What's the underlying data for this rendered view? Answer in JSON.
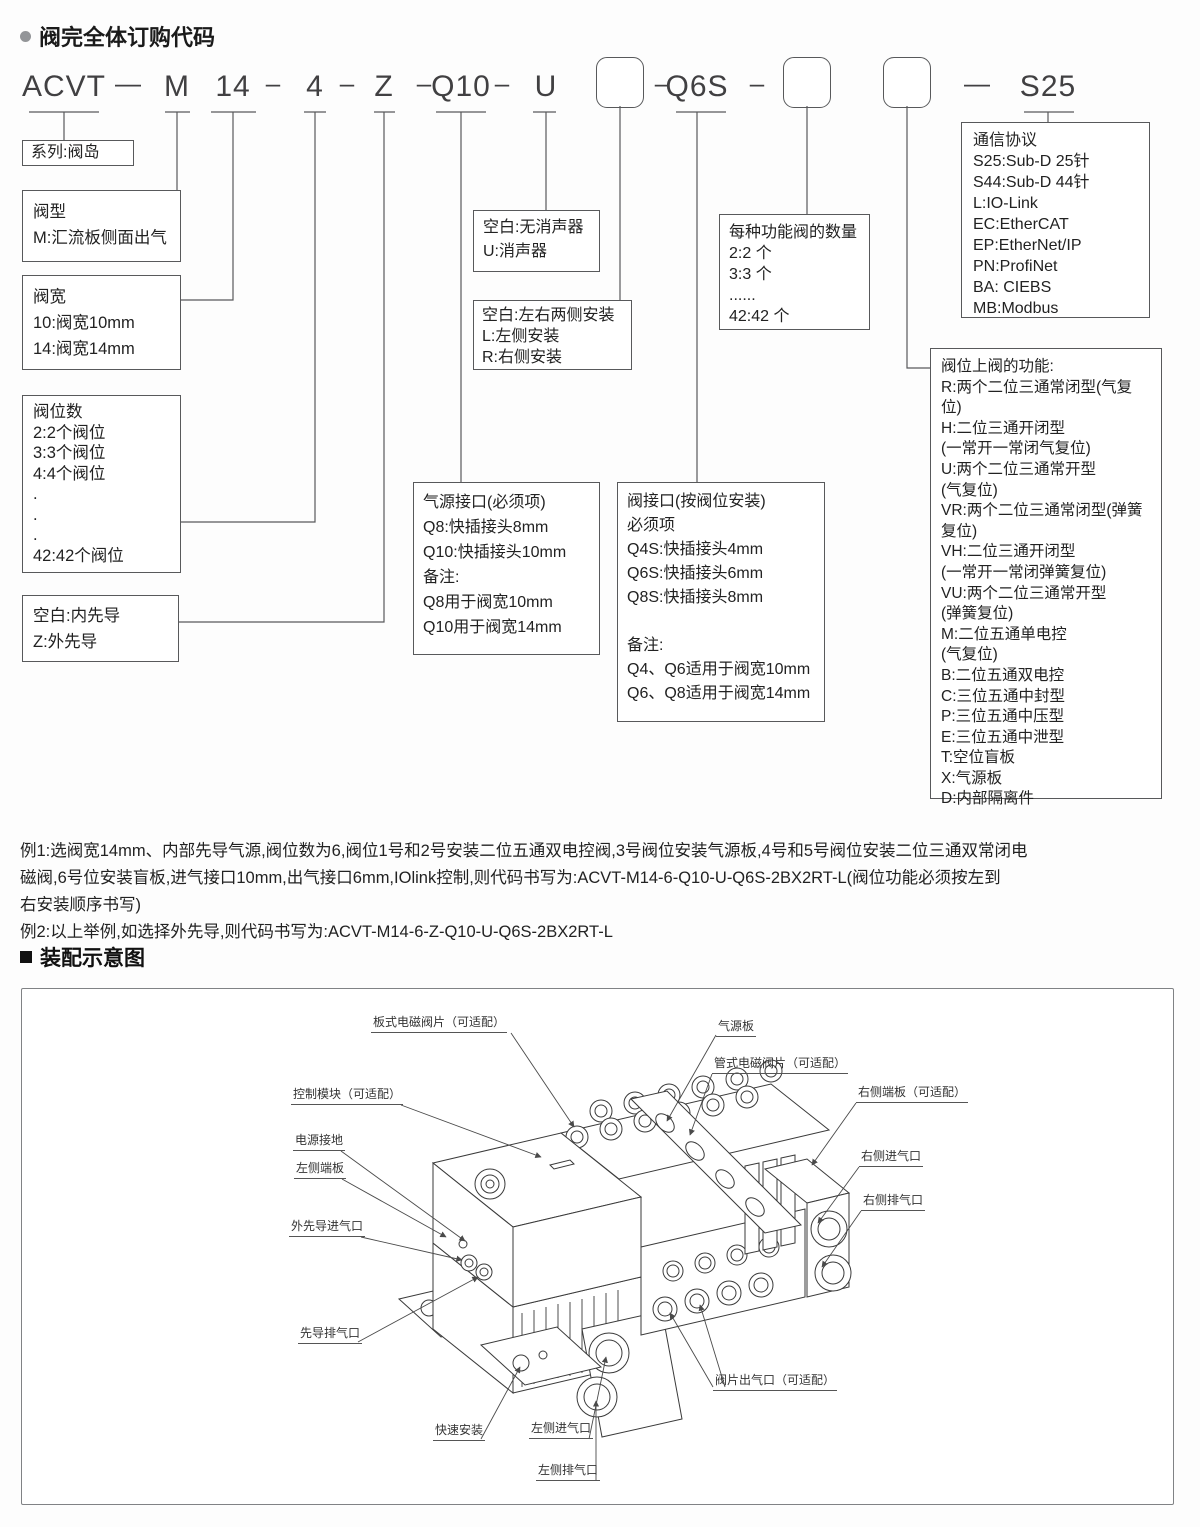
{
  "header": {
    "title": "阀完全体订购代码"
  },
  "code": {
    "segments": [
      "ACVT",
      "M",
      "14",
      "4",
      "Z",
      "Q10",
      "U",
      "Q6S",
      "S25"
    ],
    "dash_long": "—",
    "dash_short": "–"
  },
  "spec_boxes": {
    "series": "系列:阀岛",
    "valve_type": "阀型\nM:汇流板侧面出气",
    "valve_width": "阀宽\n10:阀宽10mm\n14:阀宽14mm",
    "positions": "阀位数\n2:2个阀位\n3:3个阀位\n4:4个阀位\n.\n.\n.\n42:42个阀位",
    "pilot": "空白:内先导\nZ:外先导",
    "muffler": "空白:无消声器\nU:消声器",
    "mounting": "空白:左右两侧安装\nL:左侧安装\nR:右侧安装",
    "air_port": "气源接口(必须项)\nQ8:快插接头8mm\nQ10:快插接头10mm\n备注:\nQ8用于阀宽10mm\nQ10用于阀宽14mm",
    "valve_port": "阀接口(按阀位安装)\n必须项\nQ4S:快插接头4mm\nQ6S:快插接头6mm\nQ8S:快插接头8mm\n\n备注:\nQ4、Q6适用于阀宽10mm\nQ6、Q8适用于阀宽14mm",
    "quantity": "每种功能阀的数量\n2:2 个\n3:3 个\n......\n42:42 个",
    "protocol": "通信协议\nS25:Sub-D 25针\nS44:Sub-D 44针\nL:IO-Link\nEC:EtherCAT\nEP:EtherNet/IP\nPN:ProfiNet\nBA: CIEBS\nMB:Modbus",
    "functions": "阀位上阀的功能:\nR:两个二位三通常闭型(气复位)\nH:二位三通开闭型\n(一常开一常闭气复位)\nU:两个二位三通常开型\n(气复位)\nVR:两个二位三通常闭型(弹簧复位)\nVH:二位三通开闭型\n(一常开一常闭弹簧复位)\nVU:两个二位三通常开型\n(弹簧复位)\nM:二位五通单电控\n(气复位)\nB:二位五通双电控\nC:三位五通中封型\nP:三位五通中压型\nE:三位五通中泄型\nT:空位盲板\nX:气源板\nD:内部隔离件"
  },
  "examples": {
    "text": "例1:选阀宽14mm、内部先导气源,阀位数为6,阀位1号和2号安装二位五通双电控阀,3号阀位安装气源板,4号和5号阀位安装二位三通双常闭电\n磁阀,6号位安装盲板,进气接口10mm,出气接口6mm,IOlink控制,则代码书写为:ACVT-M14-6-Q10-U-Q6S-2BX2RT-L(阀位功能必须按左到\n右安装顺序书写)\n例2:以上举例,如选择外先导,则代码书写为:ACVT-M14-6-Z-Q10-U-Q6S-2BX2RT-L"
  },
  "assembly": {
    "title": "装配示意图",
    "labels": [
      "板式电磁阀片（可适配）",
      "气源板",
      "管式电磁阀片（可适配）",
      "右侧端板（可适配）",
      "控制模块（可适配）",
      "电源接地",
      "右侧进气口",
      "左侧端板",
      "右侧排气口",
      "外先导进气口",
      "先导排气口",
      "阀片出气口（可适配）",
      "快速安装",
      "左侧进气口",
      "左侧排气口"
    ]
  }
}
